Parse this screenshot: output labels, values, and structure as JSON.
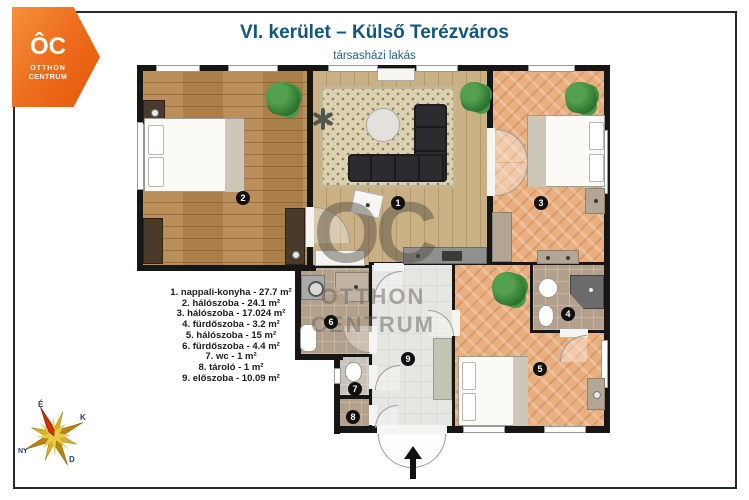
{
  "header": {
    "title": "VI. kerület – Külső Terézváros",
    "subtitle": "társasházi lakás"
  },
  "logo": {
    "monogram": "ÔC",
    "line1": "OTTHON",
    "line2": "CENTRUM"
  },
  "watermark": {
    "monogram": "OC",
    "line1": "OTTHON",
    "line2": "CENTRUM"
  },
  "plan": {
    "badges": [
      "1",
      "2",
      "3",
      "4",
      "5",
      "6",
      "7",
      "8",
      "9"
    ]
  },
  "legend": {
    "items": [
      "1. nappali-konyha - 27.7 m²",
      "2. hálószoba - 24.1 m²",
      "3. hálószoba - 17.024 m²",
      "4. fürdőszoba - 3.2 m²",
      "5. hálószoba - 15 m²",
      "6. fürdőszoba - 4.4 m²",
      "7. wc - 1 m²",
      "8. tároló - 1 m²",
      "9. előszoba - 10.09 m²"
    ]
  },
  "compass": {
    "north": "É",
    "east": "K",
    "west": "NY",
    "south": "D"
  },
  "colors": {
    "accent_orange": "#ee6f1f",
    "title_blue": "#12567d",
    "wall": "#161616",
    "legend_text": "#1b1b1b",
    "compass_gold": "#c99a1d",
    "compass_red": "#d03014"
  }
}
